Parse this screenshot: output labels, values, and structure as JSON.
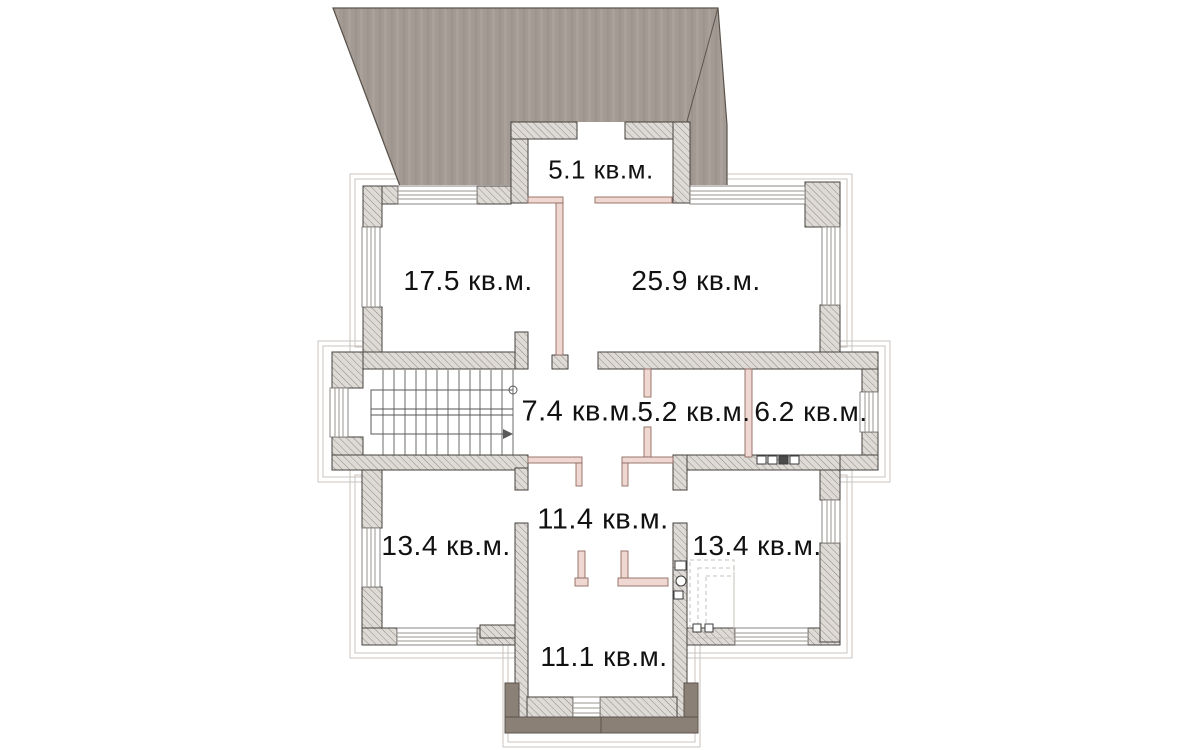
{
  "unit": "кв.м.",
  "rooms": [
    {
      "name": "room-5-1",
      "area": "5.1",
      "label": "5.1 кв.м."
    },
    {
      "name": "room-17-5",
      "area": "17.5",
      "label": "17.5 кв.м."
    },
    {
      "name": "room-25-9",
      "area": "25.9",
      "label": "25.9 кв.м."
    },
    {
      "name": "room-7-4",
      "area": "7.4",
      "label": "7.4 кв.м."
    },
    {
      "name": "room-5-2",
      "area": "5.2",
      "label": "5.2 кв.м."
    },
    {
      "name": "room-6-2",
      "area": "6.2",
      "label": "6.2 кв.м."
    },
    {
      "name": "room-11-4",
      "area": "11.4",
      "label": "11.4 кв.м."
    },
    {
      "name": "room-13-4-left",
      "area": "13.4",
      "label": "13.4 кв.м."
    },
    {
      "name": "room-13-4-right",
      "area": "13.4",
      "label": "13.4 кв.м."
    },
    {
      "name": "room-11-1",
      "area": "11.1",
      "label": "11.1 кв.м."
    }
  ],
  "colors": {
    "roof": "#a49a94",
    "roof_stripe": "#aba19b",
    "wall_fill": "#dedad6",
    "wall_hatch_line": "#8e8984",
    "wall_outline": "#45413d",
    "partition": "#f0d8d2",
    "partition_outline": "#8d6a61",
    "porch": "#8b8076",
    "window_line": "#9a958f",
    "label_text": "#111111"
  }
}
